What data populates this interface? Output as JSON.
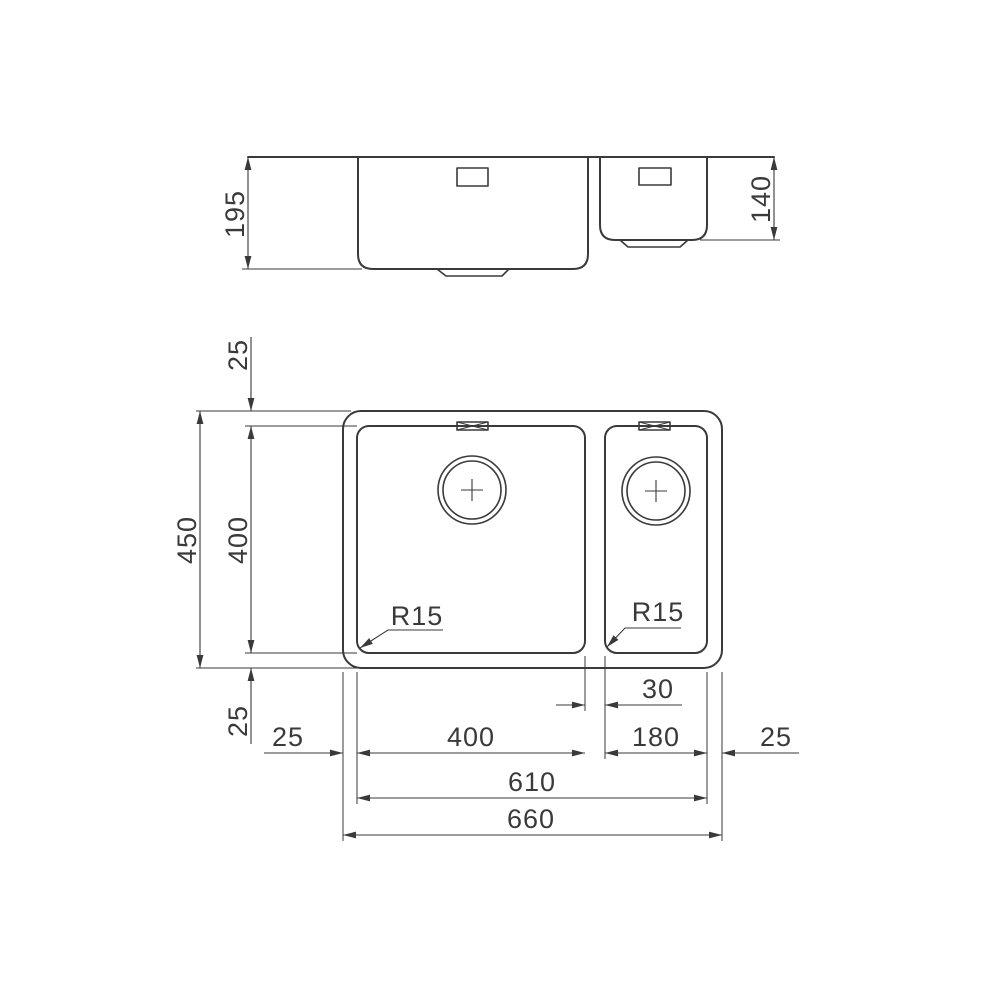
{
  "colors": {
    "line": "#3a3a3a",
    "background": "#ffffff"
  },
  "elevation_view": {
    "large_bowl_depth": "195",
    "small_bowl_depth": "140"
  },
  "plan_view": {
    "rim_top": "25",
    "bowl_length": "400",
    "overall_length": "450",
    "rim_bottom": "25",
    "rim_left": "25",
    "large_bowl_width": "400",
    "bowl_gap": "30",
    "small_bowl_width": "180",
    "rim_right": "25",
    "bowls_span": "610",
    "overall_width": "660",
    "large_bowl_corner_radius": "R15",
    "small_bowl_corner_radius": "R15"
  }
}
